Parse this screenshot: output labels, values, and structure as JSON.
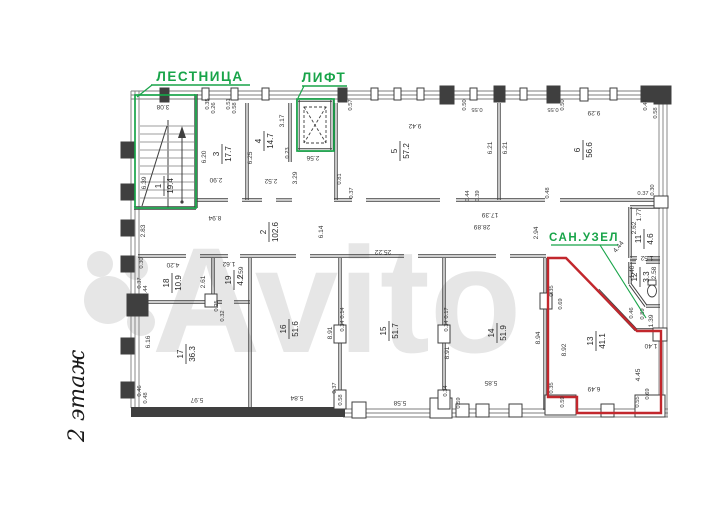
{
  "page": {
    "background": "#ffffff",
    "type": "floor-plan-drawing"
  },
  "title": {
    "floor_label": "2 этаж"
  },
  "watermark": {
    "text": "Avito"
  },
  "colors": {
    "green": "#18a449",
    "red": "#c2272d",
    "wall_dark": "#3f3f3f",
    "wall_light": "#7d7d7d",
    "text": "#262626",
    "dim_text": "#3a3a3a",
    "watermark": "#e6e6e6"
  },
  "callouts": {
    "staircase": "ЛЕСТНИЦА",
    "elevator": "ЛИФТ",
    "bathroom": "САН.УЗЕЛ"
  },
  "rooms": [
    {
      "number": "1",
      "area": "19.4"
    },
    {
      "number": "2",
      "area": "102.6"
    },
    {
      "number": "3",
      "area": "17.7"
    },
    {
      "number": "4",
      "area": "14.7"
    },
    {
      "number": "5",
      "area": "57.2"
    },
    {
      "number": "6",
      "area": "56.6"
    },
    {
      "number": "11",
      "area": "4.6"
    },
    {
      "number": "12",
      "area": "3.3"
    },
    {
      "number": "13",
      "area": "41.1"
    },
    {
      "number": "14",
      "area": "51.9"
    },
    {
      "number": "15",
      "area": "51.7"
    },
    {
      "number": "16",
      "area": "51.6"
    },
    {
      "number": "17",
      "area": "36.3"
    },
    {
      "number": "18",
      "area": "10.9"
    },
    {
      "number": "19",
      "area": "4.2"
    }
  ],
  "dimensions": [
    "3.08",
    "6.39",
    "6.20",
    "2.90",
    "6.25",
    "2.52",
    "3.17",
    "0.23",
    "2.56",
    "3.29",
    "9.42",
    "6.21",
    "6.21",
    "9.29",
    "0.57",
    "0.50",
    "0.55",
    "0.55",
    "0.50",
    "0.44",
    "0.58",
    "0.35",
    "0.26",
    "0.51",
    "0.58",
    "0.81",
    "0.37",
    "0.48",
    "0.44",
    "0.39",
    "0.37",
    "0.30",
    "8.94",
    "2.83",
    "6.14",
    "25.22",
    "28.89",
    "17.39",
    "2.94",
    "4.44",
    "2.62",
    "1.77",
    "1.52",
    "1.40",
    "2.58",
    "1.39",
    "1.40",
    "0.46",
    "0.89",
    "8.94",
    "8.92",
    "6.49",
    "4.45",
    "0.35",
    "0.69",
    "0.35",
    "0.59",
    "0.55",
    "0.69",
    "4.20",
    "2.61",
    "1.62",
    "2.59",
    "0.30",
    "6.16",
    "5.97",
    "0.46",
    "0.48",
    "5.84",
    "8.91",
    "0.37",
    "0.58",
    "5.58",
    "8.91",
    "0.34",
    "0.59",
    "5.85",
    "0.14",
    "0.34",
    "0.17",
    "0.34",
    "0.25",
    "0.32",
    "0.37",
    "0.44"
  ]
}
